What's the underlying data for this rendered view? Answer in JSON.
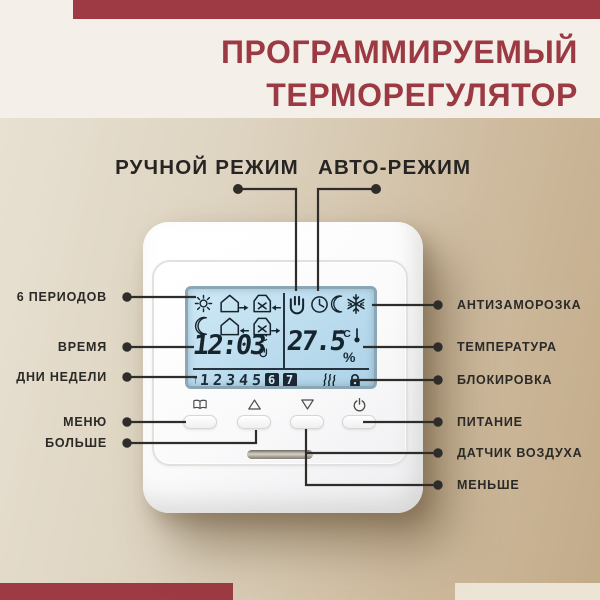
{
  "header": {
    "title_line1": "ПРОГРАММИРУЕМЫЙ",
    "title_line2": "ТЕРМОРЕГУЛЯТОР"
  },
  "mode_pointers": {
    "manual_label": "РУЧНОЙ РЕЖИМ",
    "auto_label": "АВТО-РЕЖИМ"
  },
  "callouts_left": [
    "6 ПЕРИОДОВ",
    "ВРЕМЯ",
    "ДНИ НЕДЕЛИ",
    "МЕНЮ",
    "БОЛЬШЕ"
  ],
  "callouts_right": [
    "АНТИЗАМОРОЗКА",
    "ТЕМПЕРАТУРА",
    "БЛОКИРОВКА",
    "ПИТАНИЕ",
    "ДАТЧИК ВОЗДУХА",
    "МЕНЬШЕ"
  ],
  "thermostat": {
    "display": {
      "time": "12:03",
      "time_unit": "°C",
      "temperature": "27.5",
      "temperature_unit": "°C",
      "percent_symbol": "%",
      "day_cursor": "↑",
      "days": [
        "1",
        "2",
        "3",
        "4",
        "5",
        "6",
        "7"
      ],
      "active_days": [
        "6",
        "7"
      ],
      "period_icons": [
        "sun",
        "home-leave",
        "work-arrive",
        "moon",
        "home-return",
        "work-leave"
      ],
      "mode_icons": [
        "hand-manual",
        "clock-auto",
        "moon-night",
        "snowflake-antifreeze"
      ],
      "status_icons": [
        "heating-waves",
        "keylock"
      ]
    },
    "buttons": [
      "menu-book",
      "increase",
      "decrease",
      "power"
    ]
  },
  "colors": {
    "accent_red": "#9e3a43",
    "panel_offwhite": "#f4efe9",
    "background_beige": "#d0bda0",
    "lcd_blue": "#bbdcee",
    "line_dark": "#2f2d2a"
  }
}
